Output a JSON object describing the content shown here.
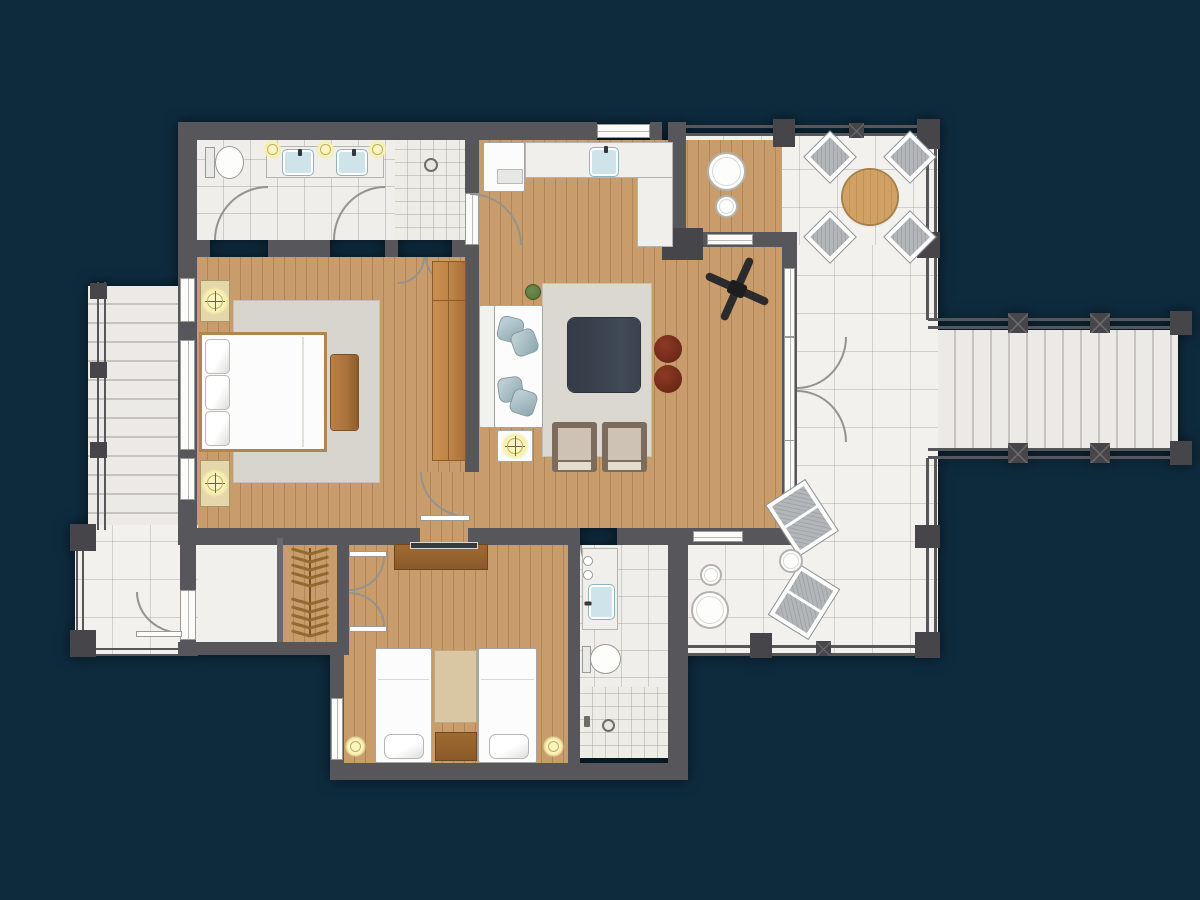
{
  "scene": {
    "type": "floor-plan",
    "description": "Top-down rendered apartment floor plan on dark navy background: two bedrooms, two bathrooms, living room with kitchenette, wrap-around L-shaped terrace with outdoor furniture, exterior stair on the left with landing porch, exterior stair on the right off the terrace",
    "background_color": "#0e2b3e"
  },
  "palette": {
    "navy": "#0e2b3e",
    "wall": "#57575b",
    "wallDark": "#46464a",
    "arcline": "#93938f",
    "wood": "#c89c6b",
    "tile": "#f3f1ed",
    "bath": "#f0eeea",
    "whiteF": "#fcfcfc",
    "counter": "#f0efec",
    "sink": "#cfe4ea",
    "glow": "#f6efad",
    "glowRing": "#bfae5d",
    "rugLiving": "#dbd8d2",
    "rugMaster": "#d8d5cf",
    "rugBeige": "#d9c6a2",
    "coffee": "#39424d",
    "pouf": "#6f2818",
    "pillow": "#a6bcc3",
    "pillowDark": "#8ba6ae",
    "armFrame": "#7b6c5c",
    "armCushion": "#cdc2b4",
    "dresser": "#8c5a29",
    "bench": "#a9713a",
    "wardrobe": "#bd8447",
    "nightstand": "#e6d6ab",
    "plant": "#5c7a3d",
    "fan": "#2b2b2d",
    "chairGray": "#b3b6b9",
    "stair": "#eceae6",
    "tableWood": "#d0a165"
  },
  "rooms": [
    {
      "id": "master-bedroom",
      "name": "Master Bedroom",
      "floor": "wood"
    },
    {
      "id": "living-room",
      "name": "Living Room / Entry",
      "floor": "wood"
    },
    {
      "id": "bathroom-1",
      "name": "Master Bathroom",
      "floor": "tile"
    },
    {
      "id": "bathroom-2",
      "name": "Second Bathroom",
      "floor": "tile"
    },
    {
      "id": "bedroom-2",
      "name": "Second Bedroom",
      "floor": "wood"
    },
    {
      "id": "closet",
      "name": "Wardrobe Closet",
      "floor": "wood"
    },
    {
      "id": "vestibule",
      "name": "Vestibule",
      "floor": "tile"
    },
    {
      "id": "landing",
      "name": "Entry Landing",
      "floor": "tile"
    },
    {
      "id": "terrace-north",
      "name": "North Terrace",
      "floor": "tile"
    },
    {
      "id": "terrace-east",
      "name": "East Terrace",
      "floor": "tile"
    },
    {
      "id": "stairs-left",
      "name": "Left Exterior Stair",
      "floor": "stone"
    },
    {
      "id": "stairs-right",
      "name": "Right Exterior Stair",
      "floor": "stone"
    }
  ],
  "furniture": {
    "bathroom_1": [
      "toilet",
      "double-sink vanity",
      "3 ceiling lights",
      "walk-in shower"
    ],
    "kitchenette": [
      "refrigerator",
      "L-shaped counter",
      "sink"
    ],
    "living_room": [
      "sofa with pillows",
      "area rug",
      "square coffee table",
      "2 round poufs",
      "2 armchairs",
      "side table with lamp",
      "potted plant",
      "ceiling fan"
    ],
    "master_bedroom": [
      "double bed",
      "2 nightstands with lamps",
      "area rug",
      "foot bench",
      "wardrobe cabinet"
    ],
    "bedroom_2": [
      "2 twin beds",
      "runner rug",
      "nightstand",
      "2 floor lamps",
      "dresser with TV"
    ],
    "bathroom_2": [
      "vanity with sink",
      "toilet",
      "shower"
    ],
    "closet": [
      "hanger rail with clothes hangers"
    ],
    "terrace_north": [
      "round dining table",
      "4 wicker chairs",
      "round side table pair"
    ],
    "terrace_east": [
      "2 lounge chairs",
      "small round table",
      "round side table pair"
    ]
  },
  "counts": {
    "closet_hangers": 10,
    "dining_chairs": 4,
    "lounge_chairs": 2,
    "left_stair_treads": 12,
    "right_stair_treads": 13
  }
}
